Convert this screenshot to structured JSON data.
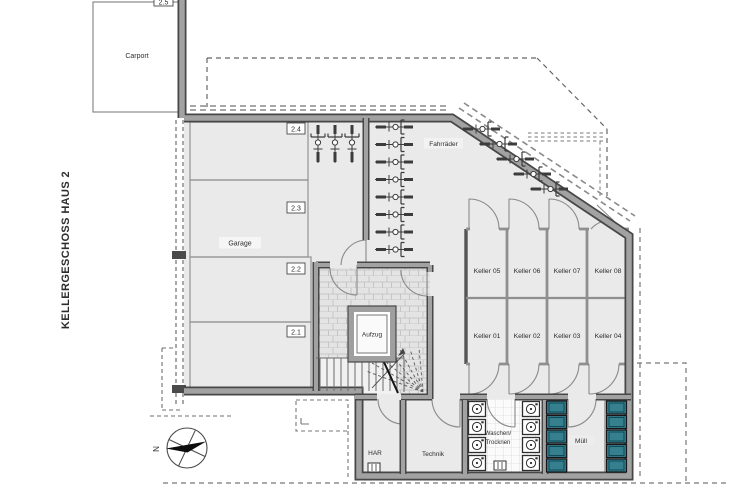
{
  "title": {
    "text": "KELLERGESCHOSS HAUS 2"
  },
  "rooms": {
    "carport": "Carport",
    "garage": "Garage",
    "bikes": "Fahrräder",
    "elevator": "Aufzug",
    "har": "HAR",
    "technik": "Technik",
    "laundry_line1": "Waschen/",
    "laundry_line2": "Trocknen",
    "waste": "Müll"
  },
  "parking_spaces": {
    "p25": "2.5",
    "p24": "2.4",
    "p23": "2.3",
    "p22": "2.2",
    "p21": "2.1"
  },
  "keller": {
    "top_row": [
      "Keller 05",
      "Keller 06",
      "Keller 07",
      "Keller 08"
    ],
    "bottom_row": [
      "Keller 01",
      "Keller 02",
      "Keller 03",
      "Keller 04"
    ]
  },
  "compass": {
    "north_label": "N"
  },
  "colors": {
    "accent_red": "#e30918",
    "bin_teal": "#357f8e",
    "wall_gray": "#9f9f9f",
    "wall_edge": "#474747",
    "floor_gray": "#eaeaea"
  },
  "icons": {
    "bicycle": "bicycle-icon",
    "washing_machine": "washing-machine-icon",
    "waste_bin": "waste-bin-icon",
    "floor_drain": "floor-drain-icon",
    "compass": "compass-icon",
    "stairs": "stairs-icon"
  }
}
